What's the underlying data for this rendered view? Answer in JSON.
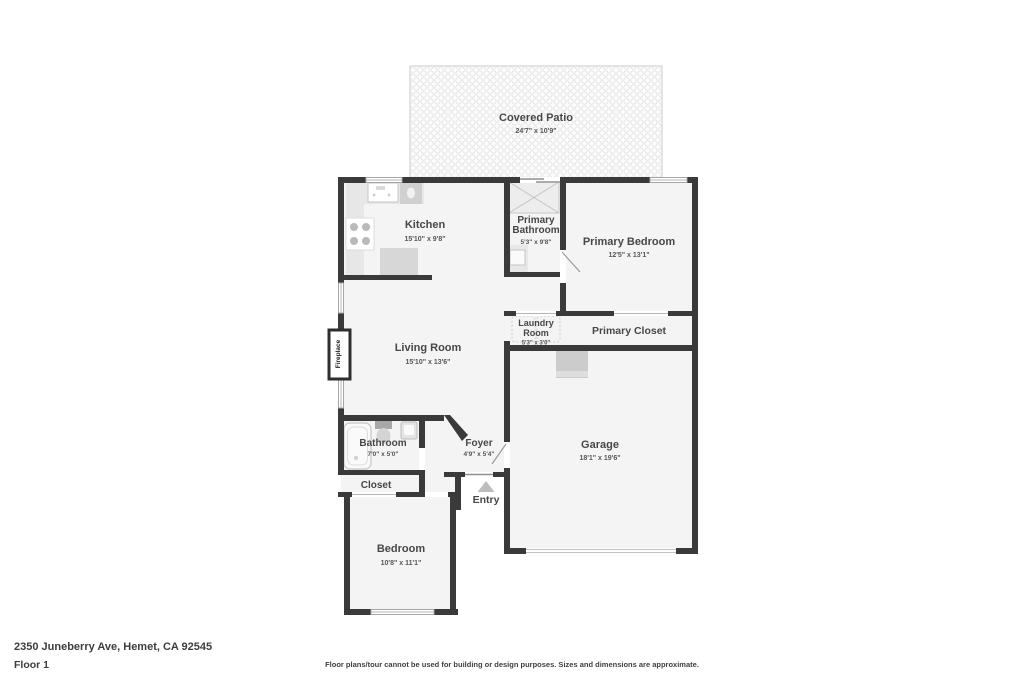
{
  "footer": {
    "address": "2350 Juneberry Ave, Hemet, CA 92545",
    "floor_label": "Floor 1",
    "disclaimer": "Floor plans/tour cannot be used for building or design purposes. Sizes and dimensions are approximate."
  },
  "rooms": {
    "covered_patio": {
      "name": "Covered Patio",
      "dims": "24'7\" x 10'9\""
    },
    "kitchen": {
      "name": "Kitchen",
      "dims": "15'10\" x 9'8\""
    },
    "primary_bathroom": {
      "line1": "Primary",
      "line2": "Bathroom",
      "dims": "5'3\" x 9'8\""
    },
    "primary_bedroom": {
      "name": "Primary Bedroom",
      "dims": "12'5\" x 13'1\""
    },
    "living_room": {
      "name": "Living Room",
      "dims": "15'10\" x 13'6\""
    },
    "laundry_room": {
      "line1": "Laundry",
      "line2": "Room",
      "dims": "5'3\" x 3'0\""
    },
    "primary_closet": {
      "name": "Primary Closet"
    },
    "garage": {
      "name": "Garage",
      "dims": "18'1\" x 19'6\""
    },
    "bathroom": {
      "name": "Bathroom",
      "dims": "7'0\" x 5'0\""
    },
    "foyer": {
      "name": "Foyer",
      "dims": "4'9\" x 5'4\""
    },
    "closet": {
      "name": "Closet"
    },
    "entry": {
      "name": "Entry"
    },
    "bedroom": {
      "name": "Bedroom",
      "dims": "10'8\" x 11'1\""
    },
    "fireplace": {
      "name": "Fireplace"
    }
  },
  "colors": {
    "wall": "#3a3a3a",
    "room_fill": "#f4f4f4",
    "fixture": "#e7e7e7",
    "fixture_dark": "#d0d0d0",
    "label_text": "#474747",
    "dims_text": "#565656",
    "patio_dot": "#e4e4e4",
    "background": "#ffffff"
  }
}
